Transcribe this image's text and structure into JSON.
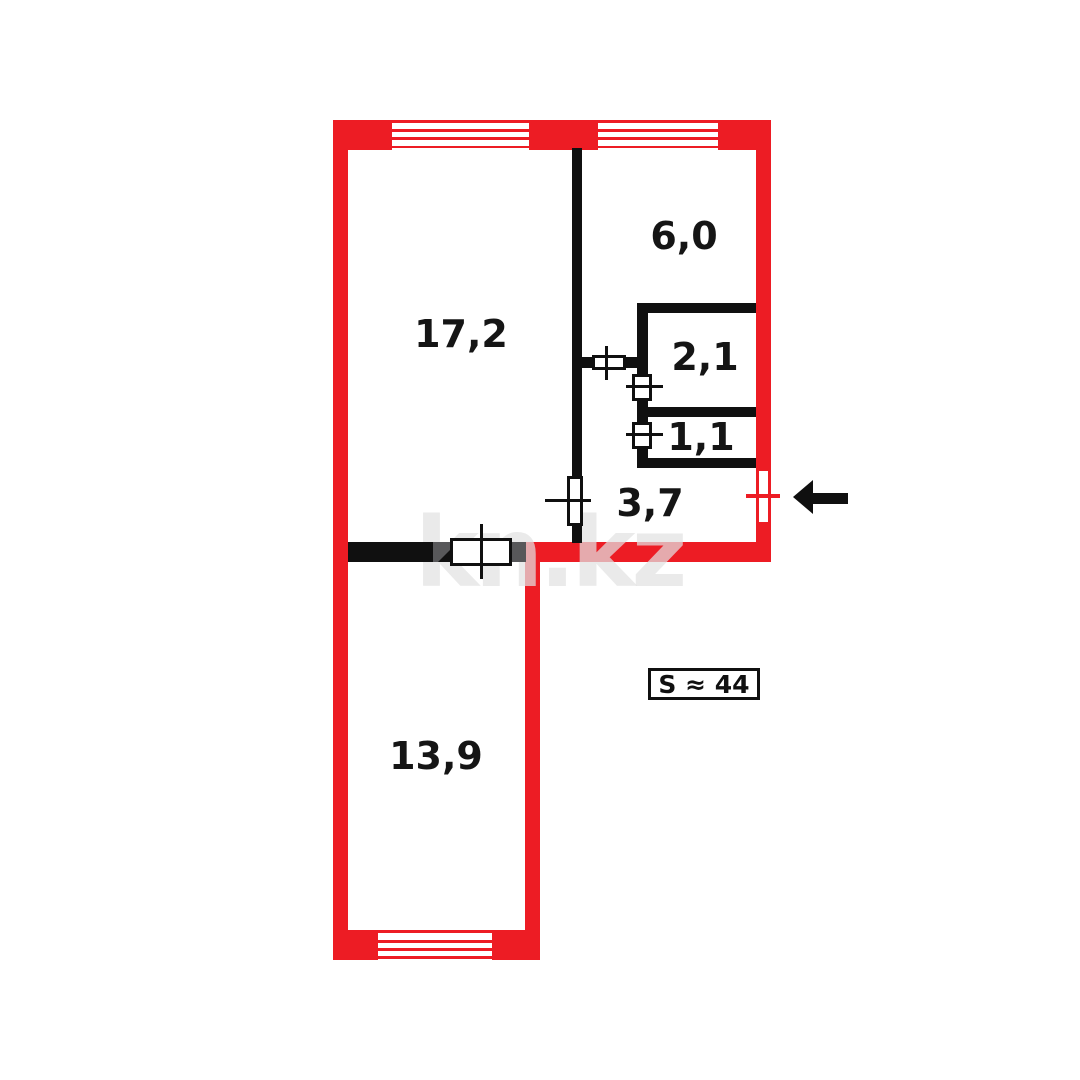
{
  "page_title": "Apartment floor plan",
  "watermark": "kn.kz",
  "total_area": {
    "label": "S ≈ 44"
  },
  "rooms": [
    {
      "id": "living-room",
      "area_label": "17,2"
    },
    {
      "id": "kitchen",
      "area_label": "6,0"
    },
    {
      "id": "bathroom",
      "area_label": "2,1"
    },
    {
      "id": "toilet",
      "area_label": "1,1"
    },
    {
      "id": "hallway",
      "area_label": "3,7"
    },
    {
      "id": "bedroom",
      "area_label": "13,9"
    }
  ],
  "icons": {
    "entrance_arrow": "arrow-left"
  },
  "colors": {
    "exterior_wall_red": "#ED1C24",
    "interior_wall_black": "#101010",
    "door_jamb_gray": "#58585A",
    "background": "#FFFFFF"
  }
}
